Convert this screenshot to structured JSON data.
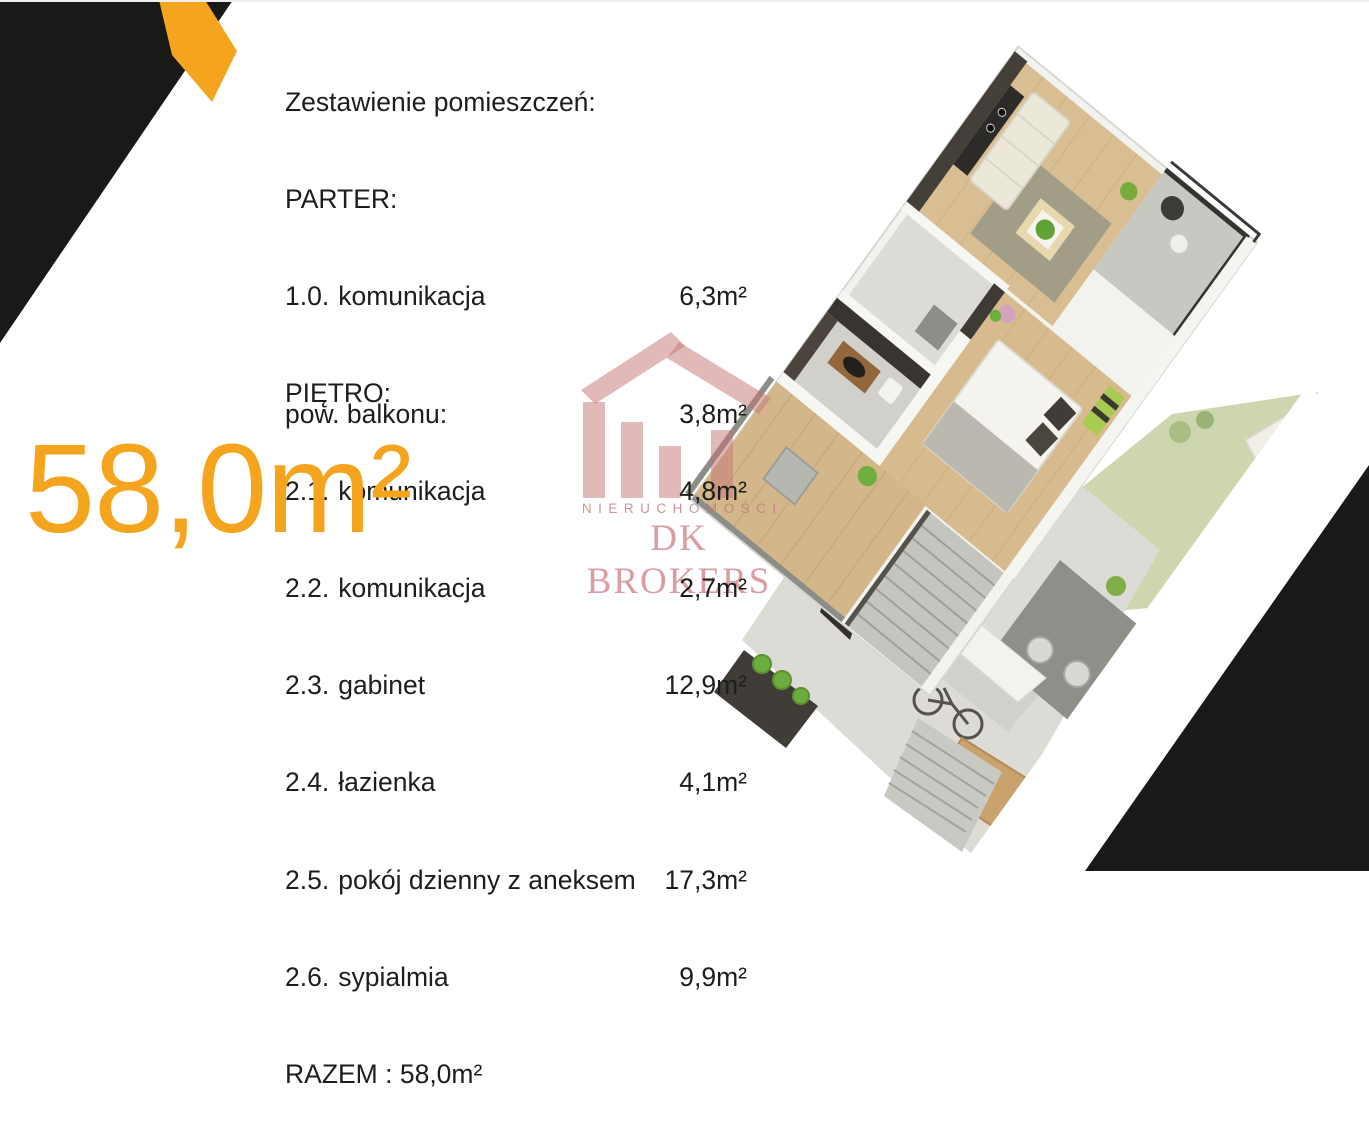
{
  "colors": {
    "accent_orange": "#F5A41D",
    "corner_black": "#191917",
    "logo_pink": "#DFA7A7",
    "text_dark": "#1D1D1B"
  },
  "room_list": {
    "title": "Zestawienie pomieszczeń:",
    "sections": [
      {
        "label": "PARTER:",
        "rooms": [
          {
            "no": "1.0.",
            "name": "komunikacja",
            "area": "6,3m²"
          }
        ]
      },
      {
        "label": "PIĘTRO:",
        "rooms": [
          {
            "no": "2.1.",
            "name": "komunikacja",
            "area": "4,8m²"
          },
          {
            "no": "2.2.",
            "name": "komunikacja",
            "area": "2,7m²"
          },
          {
            "no": "2.3.",
            "name": "gabinet",
            "area": "12,9m²"
          },
          {
            "no": "2.4.",
            "name": "łazienka",
            "area": "4,1m²"
          },
          {
            "no": "2.5.",
            "name": "pokój dzienny z aneksem",
            "area": "17,3m²"
          },
          {
            "no": "2.6.",
            "name": "sypialmia",
            "area": "9,9m²"
          }
        ]
      }
    ],
    "total": "RAZEM : 58,0m²",
    "balcony_label": "pow. balkonu:",
    "balcony_area": "3,8m²"
  },
  "highlight": {
    "total_area": "58,0m²"
  },
  "logo": {
    "line1": "NIERUCHOMOŚCI",
    "line2": "DK BROKERS"
  }
}
